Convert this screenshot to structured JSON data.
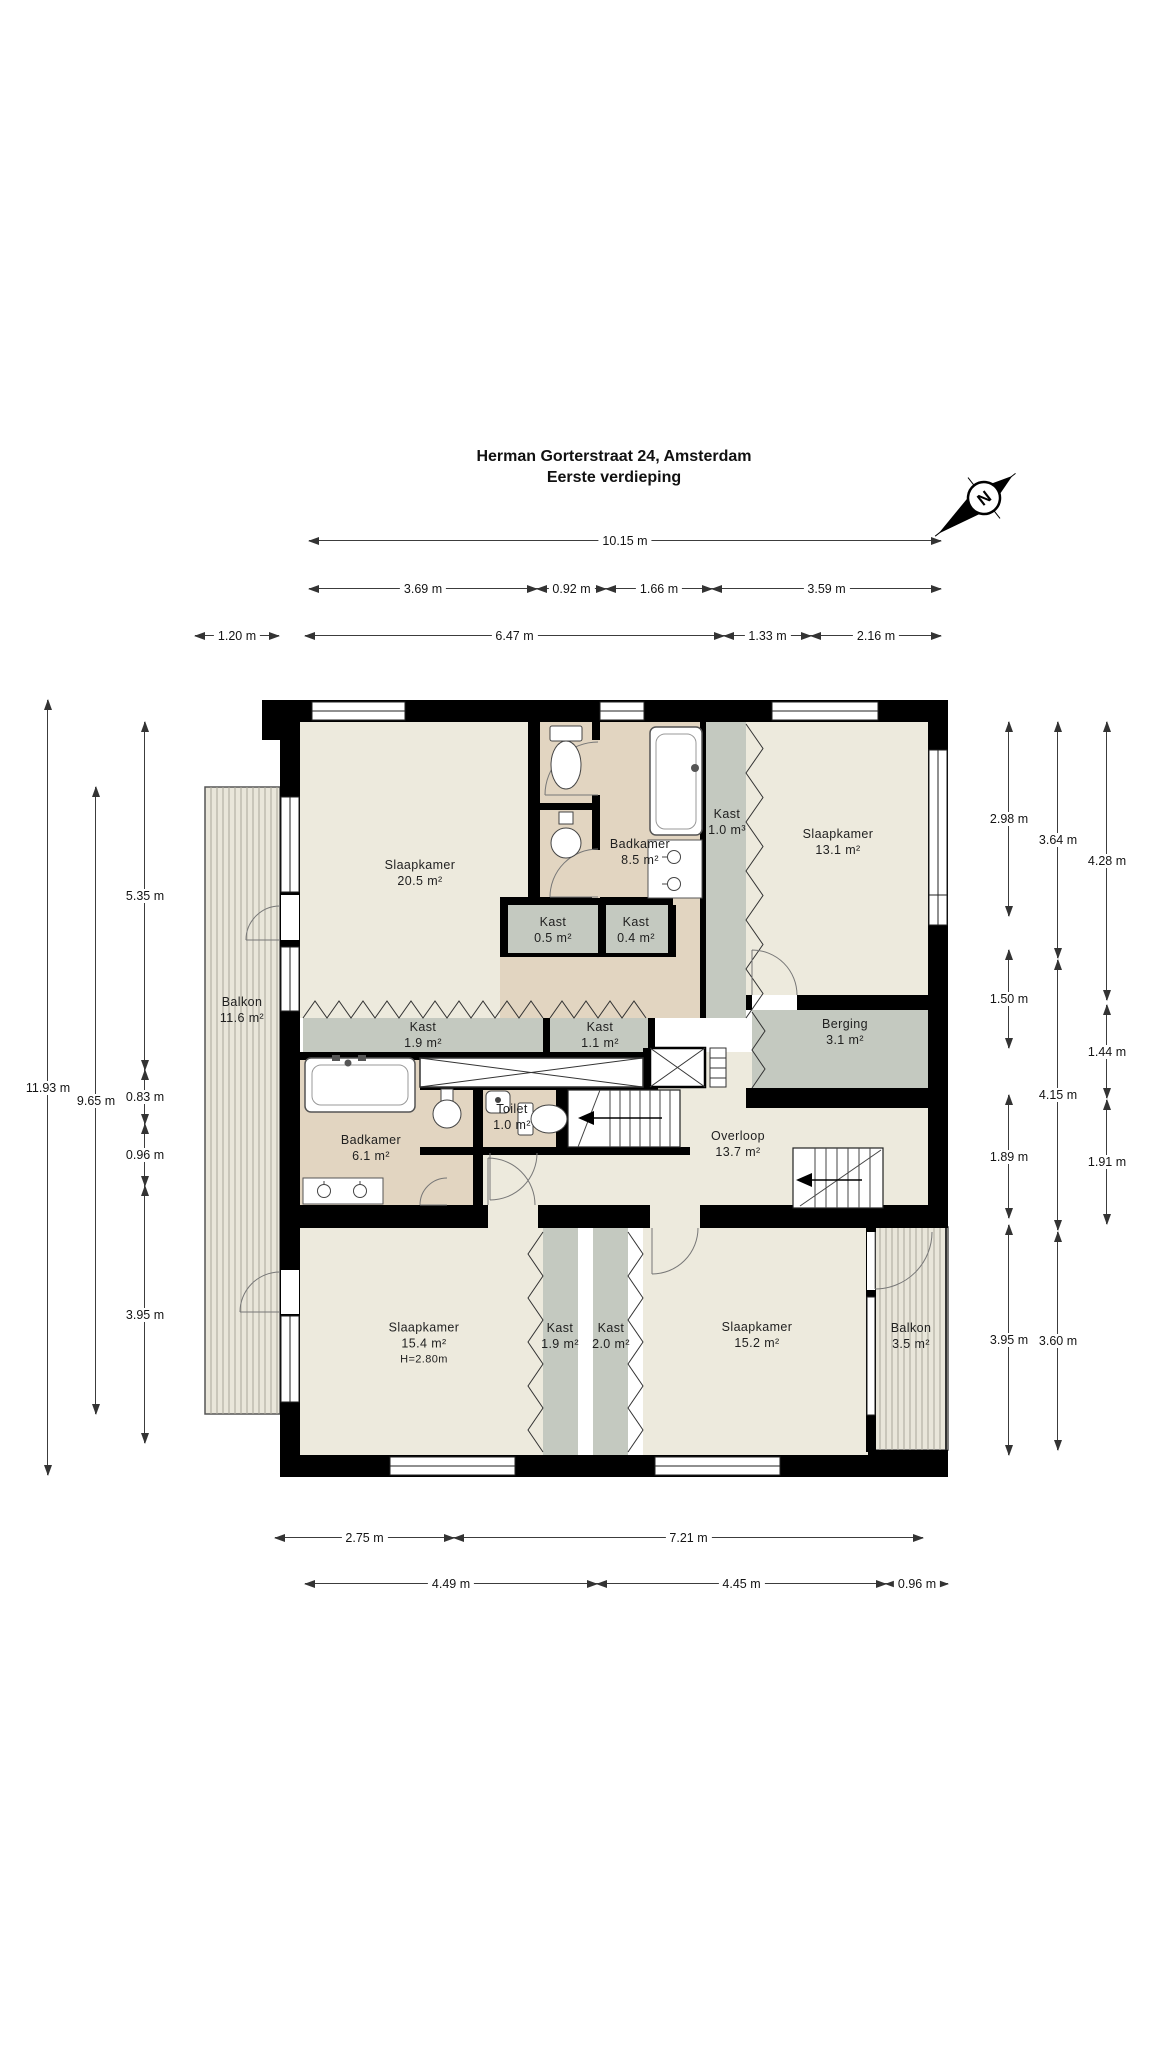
{
  "title": {
    "line1": "Herman Gorterstraat 24, Amsterdam",
    "line2": "Eerste verdieping"
  },
  "compass": {
    "label": "N"
  },
  "colors": {
    "wall": "#000000",
    "floor_room": "#edeadd",
    "floor_wet": "#e2d5c1",
    "floor_closet": "#c4c9c0",
    "balcony": "#e9e6da",
    "dim_text": "#141414"
  },
  "plan": {
    "rooms": [
      {
        "id": "slaapkamer-20-5",
        "lines": [
          "Slaapkamer",
          "20.5 m²"
        ],
        "cx": 420,
        "cy": 873
      },
      {
        "id": "badkamer-8-5",
        "lines": [
          "Badkamer",
          "8.5 m²"
        ],
        "cx": 640,
        "cy": 852
      },
      {
        "id": "kast-1-0",
        "lines": [
          "Kast",
          "1.0 m³"
        ],
        "cx": 727,
        "cy": 822
      },
      {
        "id": "slaapkamer-13-1",
        "lines": [
          "Slaapkamer",
          "13.1 m²"
        ],
        "cx": 838,
        "cy": 842
      },
      {
        "id": "kast-0-5",
        "lines": [
          "Kast",
          "0.5 m²"
        ],
        "cx": 553,
        "cy": 930
      },
      {
        "id": "kast-0-4",
        "lines": [
          "Kast",
          "0.4 m²"
        ],
        "cx": 636,
        "cy": 930
      },
      {
        "id": "kast-1-9-boven",
        "lines": [
          "Kast",
          "1.9 m²"
        ],
        "cx": 423,
        "cy": 1035
      },
      {
        "id": "kast-1-1",
        "lines": [
          "Kast",
          "1.1 m²"
        ],
        "cx": 600,
        "cy": 1035
      },
      {
        "id": "berging-3-1",
        "lines": [
          "Berging",
          "3.1 m²"
        ],
        "cx": 845,
        "cy": 1032
      },
      {
        "id": "balkon-11-6",
        "lines": [
          "Balkon",
          "11.6 m²"
        ],
        "cx": 242,
        "cy": 1010
      },
      {
        "id": "badkamer-6-1",
        "lines": [
          "Badkamer",
          "6.1 m²"
        ],
        "cx": 371,
        "cy": 1148
      },
      {
        "id": "toilet-1-0",
        "lines": [
          "Toilet",
          "1.0 m²"
        ],
        "cx": 512,
        "cy": 1117
      },
      {
        "id": "overloop-13-7",
        "lines": [
          "Overloop",
          "13.7 m²"
        ],
        "cx": 738,
        "cy": 1144
      },
      {
        "id": "slaapkamer-15-4",
        "lines": [
          "Slaapkamer",
          "15.4 m²",
          "H=2.80m"
        ],
        "cx": 424,
        "cy": 1343
      },
      {
        "id": "kast-1-9-onder",
        "lines": [
          "Kast",
          "1.9 m²"
        ],
        "cx": 560,
        "cy": 1336
      },
      {
        "id": "kast-2-0",
        "lines": [
          "Kast",
          "2.0 m²"
        ],
        "cx": 611,
        "cy": 1336
      },
      {
        "id": "slaapkamer-15-2",
        "lines": [
          "Slaapkamer",
          "15.2 m²"
        ],
        "cx": 757,
        "cy": 1335
      },
      {
        "id": "balkon-3-5",
        "lines": [
          "Balkon",
          "3.5 m²"
        ],
        "cx": 911,
        "cy": 1336
      }
    ],
    "dimensions": {
      "horizontal": [
        {
          "y": 540,
          "segments": [
            {
              "label": "10.15 m",
              "x1": 309,
              "x2": 941
            }
          ]
        },
        {
          "y": 588,
          "segments": [
            {
              "label": "3.69 m",
              "x1": 309,
              "x2": 537
            },
            {
              "label": "0.92 m",
              "x1": 537,
              "x2": 606
            },
            {
              "label": "1.66 m",
              "x1": 606,
              "x2": 712
            },
            {
              "label": "3.59 m",
              "x1": 712,
              "x2": 941
            }
          ]
        },
        {
          "y": 635,
          "segments": [
            {
              "label": "1.20 m",
              "x1": 195,
              "x2": 279
            },
            {
              "label": "6.47 m",
              "x1": 305,
              "x2": 724
            },
            {
              "label": "1.33 m",
              "x1": 724,
              "x2": 811
            },
            {
              "label": "2.16 m",
              "x1": 811,
              "x2": 941
            }
          ]
        },
        {
          "y": 1537,
          "segments": [
            {
              "label": "2.75 m",
              "x1": 275,
              "x2": 454
            },
            {
              "label": "7.21 m",
              "x1": 454,
              "x2": 923
            }
          ]
        },
        {
          "y": 1583,
          "segments": [
            {
              "label": "4.49 m",
              "x1": 305,
              "x2": 597
            },
            {
              "label": "4.45 m",
              "x1": 597,
              "x2": 886
            },
            {
              "label": "0.96 m",
              "x1": 886,
              "x2": 948
            }
          ]
        }
      ],
      "vertical": [
        {
          "x": 47,
          "segments": [
            {
              "label": "11.93 m",
              "y1": 700,
              "y2": 1475
            }
          ]
        },
        {
          "x": 95,
          "segments": [
            {
              "label": "9.65 m",
              "y1": 787,
              "y2": 1414
            }
          ]
        },
        {
          "x": 144,
          "segments": [
            {
              "label": "5.35 m",
              "y1": 722,
              "y2": 1070
            },
            {
              "label": "0.83 m",
              "y1": 1070,
              "y2": 1124
            },
            {
              "label": "0.96 m",
              "y1": 1124,
              "y2": 1186
            },
            {
              "label": "3.95 m",
              "y1": 1186,
              "y2": 1443
            }
          ]
        },
        {
          "x": 1008,
          "segments": [
            {
              "label": "2.98 m",
              "y1": 722,
              "y2": 916
            },
            {
              "label": "1.50 m",
              "y1": 950,
              "y2": 1048
            },
            {
              "label": "1.89 m",
              "y1": 1095,
              "y2": 1218
            },
            {
              "label": "3.95 m",
              "y1": 1225,
              "y2": 1455
            }
          ]
        },
        {
          "x": 1057,
          "segments": [
            {
              "label": "3.64 m",
              "y1": 722,
              "y2": 958
            },
            {
              "label": "4.15 m",
              "y1": 960,
              "y2": 1230
            },
            {
              "label": "3.60 m",
              "y1": 1232,
              "y2": 1450
            }
          ]
        },
        {
          "x": 1106,
          "segments": [
            {
              "label": "4.28 m",
              "y1": 722,
              "y2": 1000
            },
            {
              "label": "1.44 m",
              "y1": 1005,
              "y2": 1098
            },
            {
              "label": "1.91 m",
              "y1": 1100,
              "y2": 1224
            }
          ]
        }
      ]
    }
  }
}
